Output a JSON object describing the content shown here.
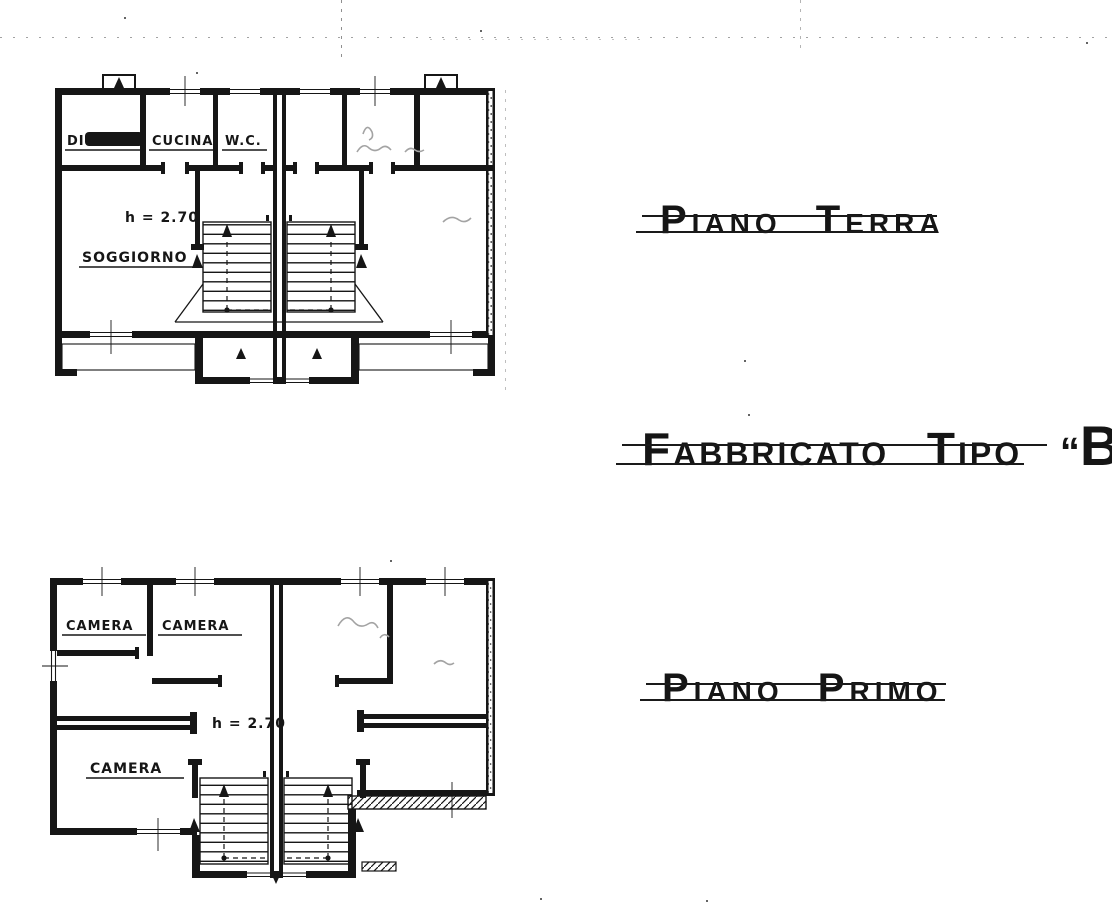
{
  "palette": {
    "paper": "#ffffff",
    "ink": "#151515",
    "pencil": "#a3a3a3"
  },
  "titles": {
    "floor1": "Piano Terra",
    "building_text": "Fabbricato Tipo",
    "building_quote_open": "“",
    "building_unit": "B",
    "building_quote_close": "„",
    "floor2": "Piano Primo"
  },
  "ground_floor": {
    "room_scribbled": "DI",
    "room_kitchen": "CUCINA",
    "room_wc": "W.C.",
    "room_living": "SOGGIORNO",
    "height_note": "h = 2.70"
  },
  "first_floor": {
    "room_bedroom_1": "CAMERA",
    "room_bedroom_2": "CAMERA",
    "room_bedroom_3": "CAMERA",
    "height_note": "h = 2.70"
  }
}
